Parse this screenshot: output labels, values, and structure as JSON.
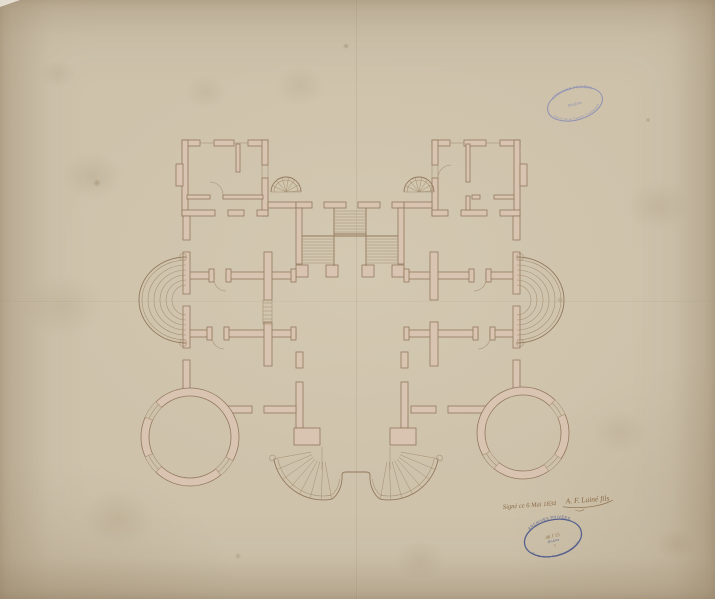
{
  "document": {
    "kind": "scanned-architectural-floor-plan",
    "media": "ink on aged paper",
    "plan_features": [
      "northwest-pavilion",
      "northeast-pavilion",
      "grand-central-staircase",
      "left-spiral-stair",
      "right-spiral-stair",
      "west-curved-garden-steps",
      "east-curved-garden-steps",
      "southwest-round-tower",
      "southeast-round-tower",
      "south-horseshoe-stair",
      "central-vestibule",
      "transverse-walls"
    ]
  },
  "stamps": {
    "top": {
      "arc_top": "ARCHIVES PRIVÉES",
      "center": "Rhône",
      "arc_bottom": "Fonds de la Famille CHAPONAY"
    },
    "bottom": {
      "arc_top": "ARCHIVES PRIVÉES",
      "cote": "46 J 15",
      "center": "Rhône",
      "number": "1",
      "arc_bottom": "Fonds de la Famille CHAPONAY"
    }
  },
  "annotation": {
    "line": "Signé ce 6 Mai 1834",
    "signature": "A. F. Lainé fils"
  },
  "colors": {
    "paper": "#cec2ab",
    "ink": "#8d7257",
    "wall_fill": "#dac4b2",
    "stamp_blue_light": "#7d84b6",
    "stamp_blue_dark": "#4e598c",
    "annotation_ink": "#8a6a45"
  }
}
